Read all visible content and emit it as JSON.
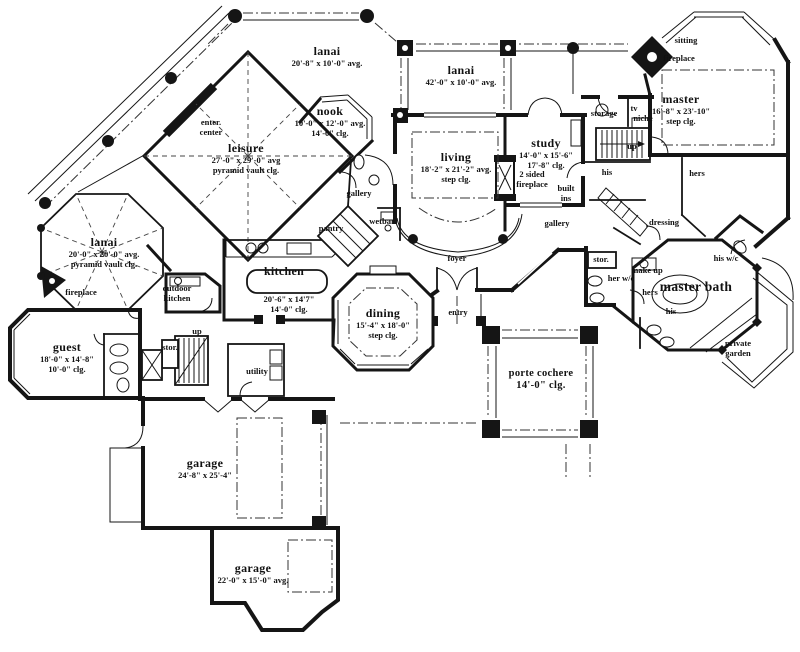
{
  "drawing_title": "single level house floor plan",
  "colors": {
    "ink": "#151515",
    "paper": "#ffffff"
  },
  "rooms": {
    "lanai_nw": {
      "name": "lanai",
      "size": "20'-8\" x 10'-0\" avg."
    },
    "lanai_n": {
      "name": "lanai",
      "size": "42'-0\" x 10'-0\" avg."
    },
    "lanai_w": {
      "name": "lanai",
      "size": "20'-0\" x 20'-0\" avg.",
      "ceiling": "pyramid vault clg."
    },
    "leisure": {
      "name": "leisure",
      "size": "27'-0\" x 29'-0\" avg",
      "ceiling": "pyramid vault clg."
    },
    "nook": {
      "name": "nook",
      "size": "10'-0\" x 12'-0\" avg.",
      "ceiling": "14'-0\" clg."
    },
    "living": {
      "name": "living",
      "size": "18'-2\" x 21'-2\" avg.",
      "ceiling": "step clg."
    },
    "study": {
      "name": "study",
      "size": "14'-0\" x 15'-6\"",
      "ceiling": "17'-8\" clg."
    },
    "master": {
      "name": "master",
      "size": "16'-8\" x 23'-10\"",
      "ceiling": "step clg."
    },
    "kitchen": {
      "name": "kitchen",
      "size": "20'-6\" x 14'7\"",
      "ceiling": "14'-0\" clg."
    },
    "dining": {
      "name": "dining",
      "size": "15'-4\" x 18'-0\"",
      "ceiling": "step clg."
    },
    "guest": {
      "name": "guest",
      "size": "18'-0\" x 14'-8\"",
      "ceiling": "10'-0\" clg."
    },
    "master_bath": {
      "name": "master bath"
    },
    "porte_cochere": {
      "name": "porte cochere",
      "ceiling": "14'-0\" clg."
    },
    "garage_main": {
      "name": "garage",
      "size": "24'-8\" x 25'-4\""
    },
    "garage_second": {
      "name": "garage",
      "size": "22'-0\" x 15'-0\" avg."
    }
  },
  "labels": {
    "sitting": "sitting",
    "fireplace_master": "fireplace",
    "fireplace_lanai": "fireplace",
    "enter_center_1": "enter.",
    "enter_center_2": "center",
    "storage": "storage",
    "tv": "tv",
    "niche": "niche",
    "up_rear": "up",
    "up_main": "up",
    "his_closet": "his",
    "hers_closet": "hers",
    "built_ins_1": "built",
    "built_ins_2": "ins",
    "fireplace_2sided_1": "2 sided",
    "fireplace_2sided_2": "fireplace",
    "gallery_west": "gallery",
    "gallery_east": "gallery",
    "wetbar": "wetbar",
    "pantry": "pantry",
    "dressing": "dressing",
    "outdoor_kitchen_1": "outdoor",
    "outdoor_kitchen_2": "kitchen",
    "foyer": "foyer",
    "entry": "entry",
    "stor_master": "stor.",
    "stor_main": "stor.",
    "make_up": "make up",
    "her_wc": "her w/c",
    "hers_bath": "hers",
    "his_wc": "his w/c",
    "his_bath": "his",
    "private_garden_1": "private",
    "private_garden_2": "garden",
    "utility": "utility"
  }
}
